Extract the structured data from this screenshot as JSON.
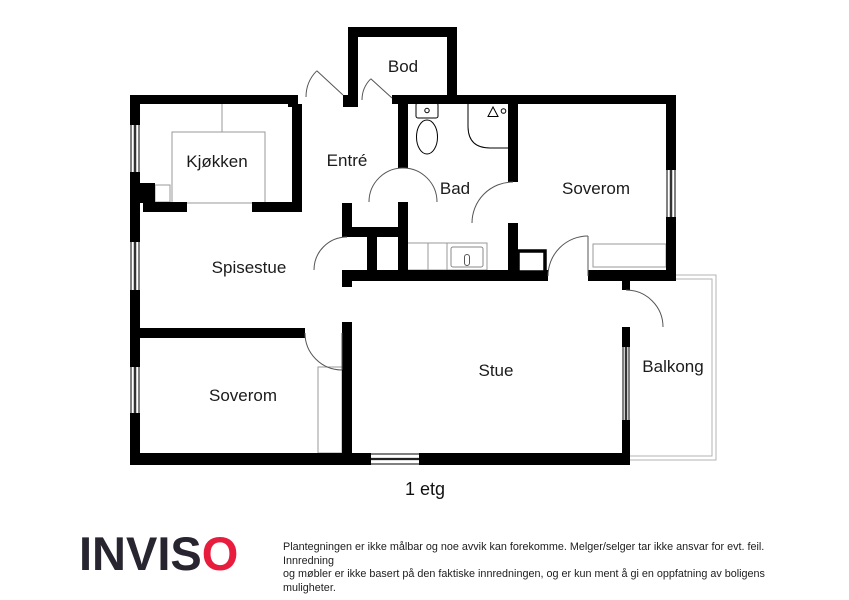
{
  "plan": {
    "rooms": {
      "bod": "Bod",
      "kjokken": "Kjøkken",
      "entre": "Entré",
      "bad": "Bad",
      "soverom_ne": "Soverom",
      "spisestue": "Spisestue",
      "soverom_sw": "Soverom",
      "stue": "Stue",
      "balkong": "Balkong"
    },
    "floor_label": "1 etg"
  },
  "branding": {
    "logo_text_dark": "INVIS",
    "logo_text_accent": "O"
  },
  "disclaimer": {
    "line1": "Plantegningen er ikke målbar og noe avvik kan forekomme. Melger/selger tar ikke ansvar for evt. feil. Innredning",
    "line2": "og møbler er ikke basert på den faktiske innredningen, og er kun ment å gi en oppfatning av boligens muligheter."
  },
  "colors": {
    "wall": "#000000",
    "accent_red": "#e81d3d",
    "furniture_line": "#999999",
    "balcony_line": "#b3b3b3",
    "label_text": "#1b1b1b"
  }
}
